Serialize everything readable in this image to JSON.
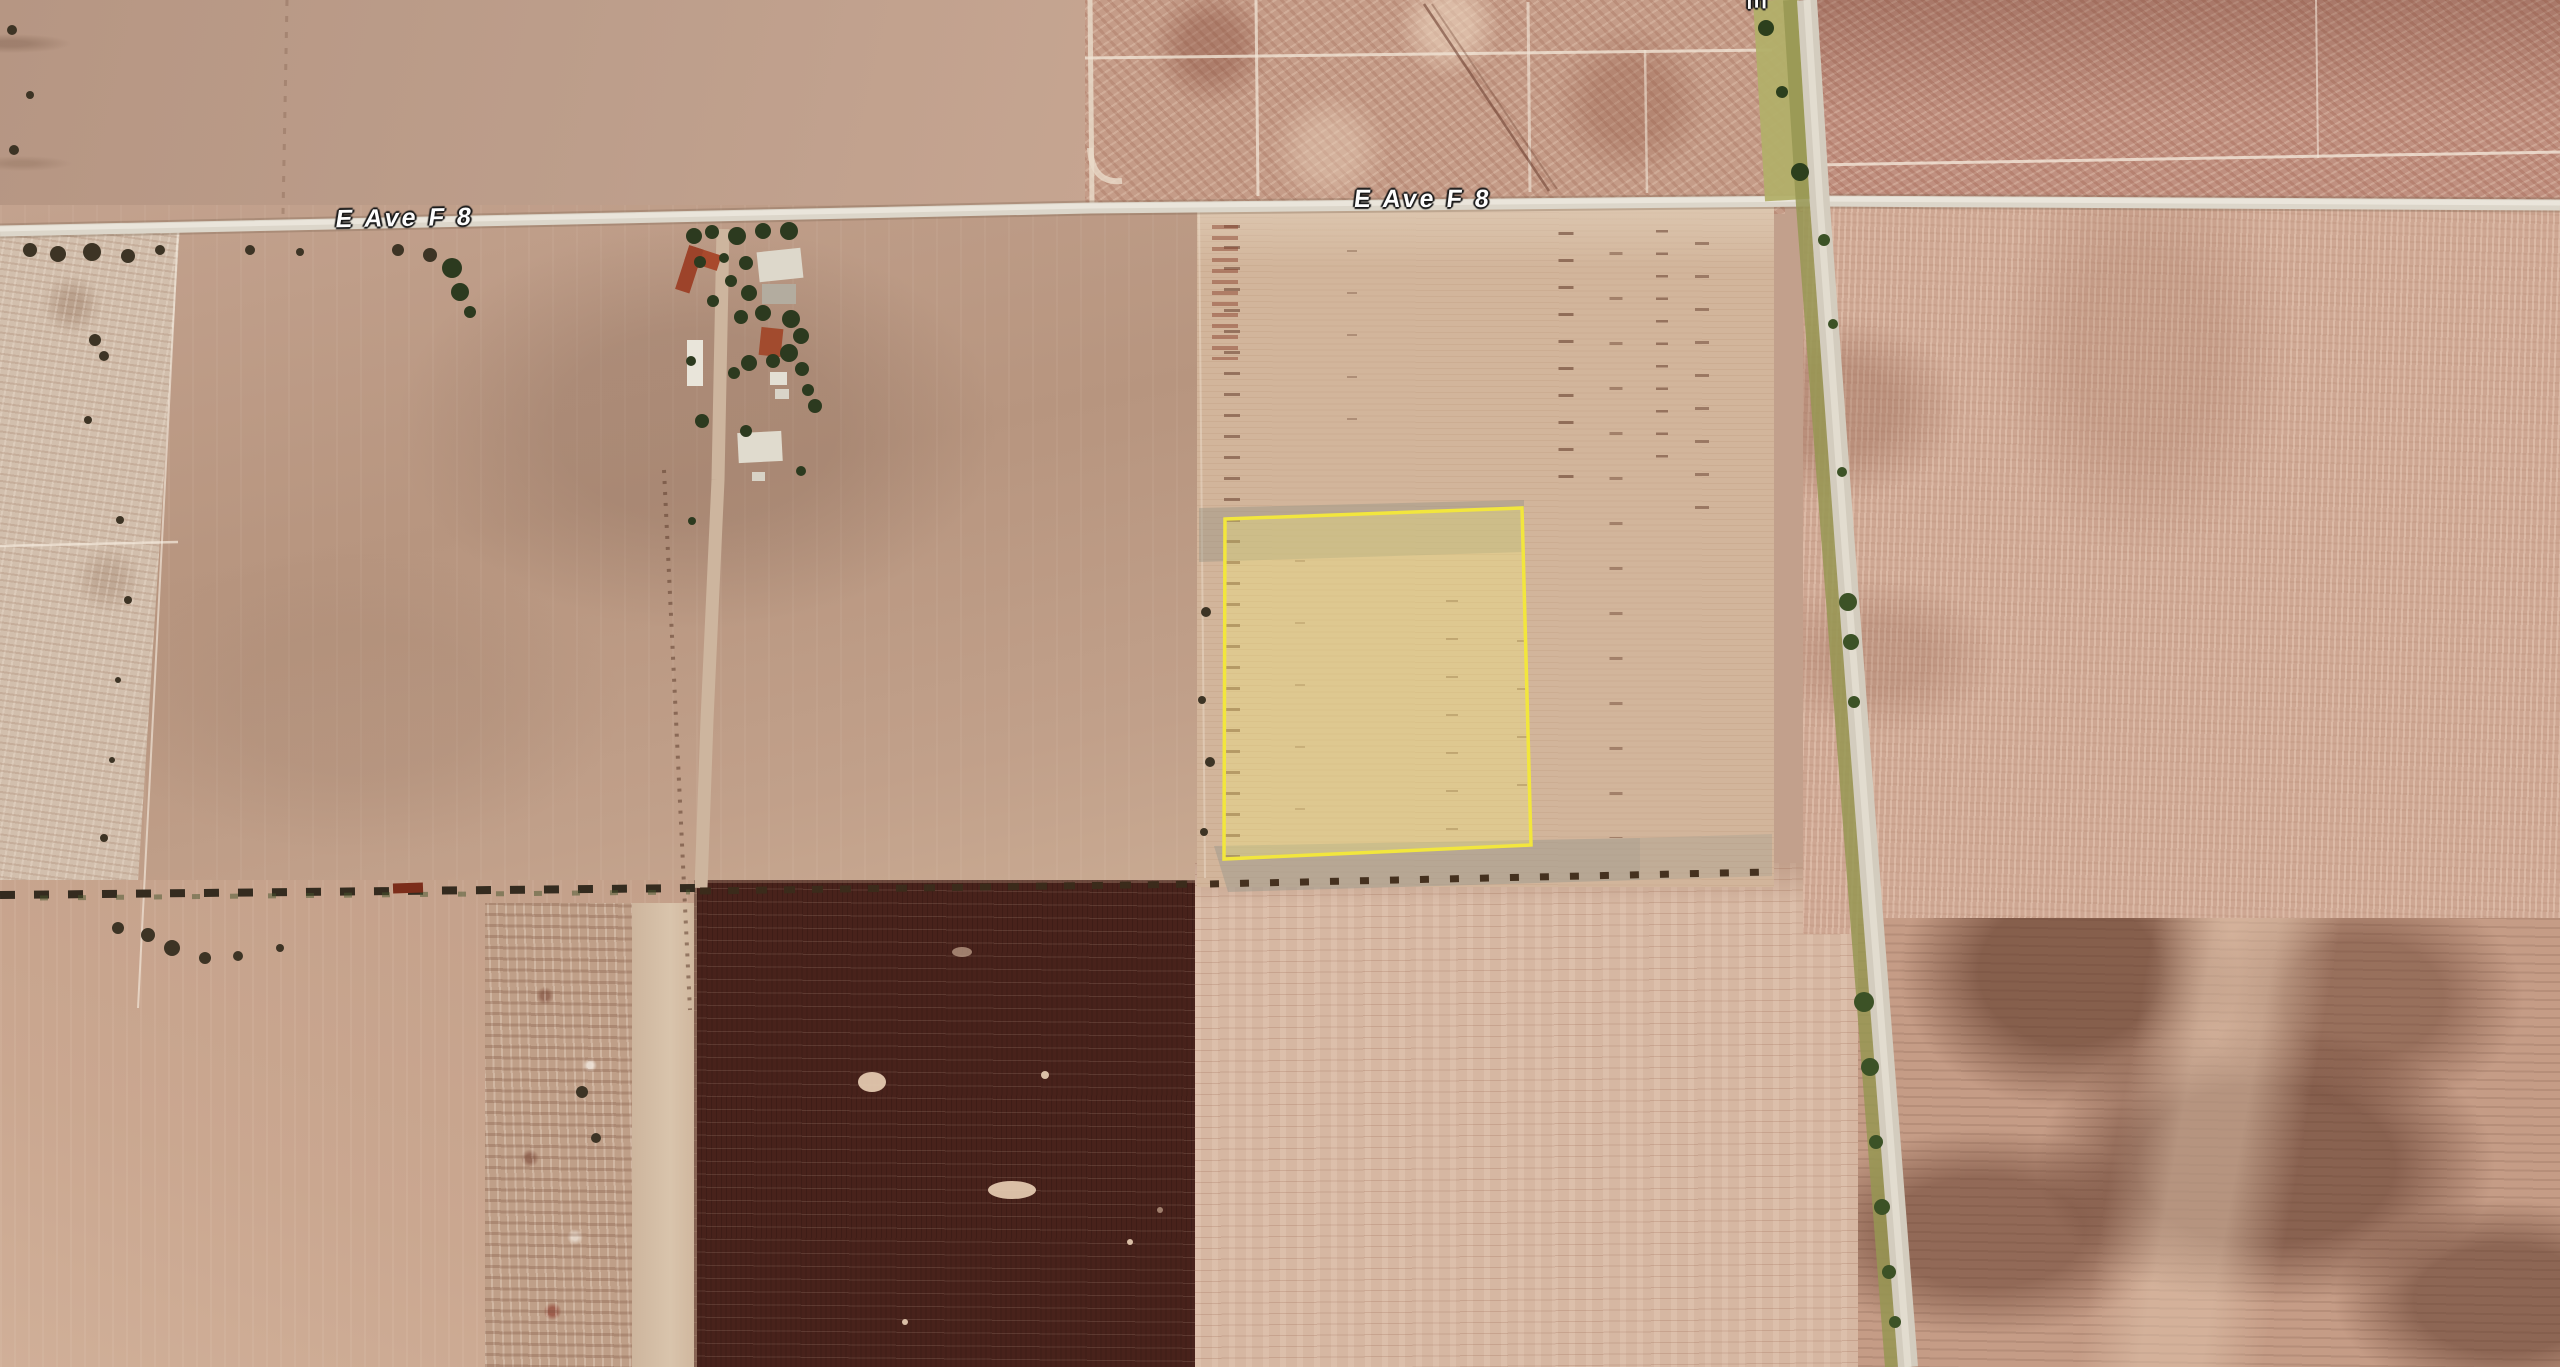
{
  "map": {
    "view": "satellite-aerial-farmland",
    "road_labels": [
      {
        "id": "ave-f8-west",
        "text": "E Ave F 8"
      },
      {
        "id": "ave-f8-center",
        "text": "E Ave F 8"
      },
      {
        "id": "north-road-partial",
        "text": "E"
      }
    ],
    "selected_parcel": {
      "stroke": "#f2e63d",
      "fill": "rgba(250,240,120,0.32)",
      "stroke_width": "3.5"
    }
  }
}
